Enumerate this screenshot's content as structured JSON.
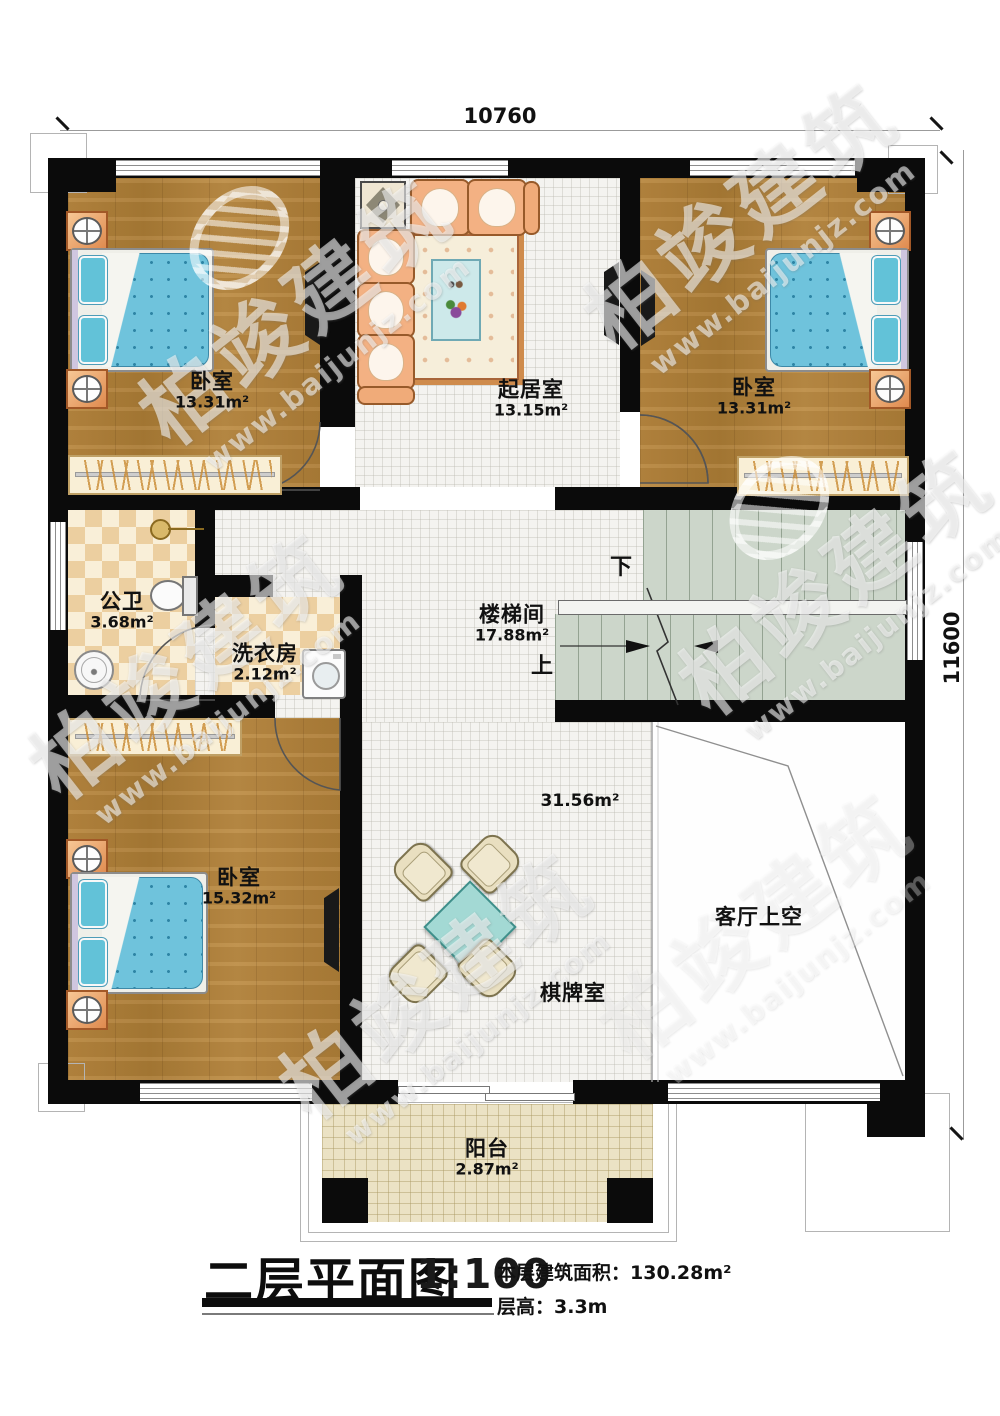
{
  "plan": {
    "dimensions": {
      "width_top": "10760",
      "height_right": "11600"
    },
    "rooms": [
      {
        "name": "卧室",
        "area": "13.31m²"
      },
      {
        "name": "起居室",
        "area": "13.15m²"
      },
      {
        "name": "卧室",
        "area": "13.31m²"
      },
      {
        "name": "公卫",
        "area": "3.68m²"
      },
      {
        "name": "洗衣房",
        "area": "2.12m²"
      },
      {
        "name": "楼梯间",
        "area": "17.88m²"
      },
      {
        "name": "卧室",
        "area": "15.32m²"
      },
      {
        "name": "棋牌室",
        "area": "31.56m²"
      },
      {
        "name": "客厅上空"
      },
      {
        "name": "阳台",
        "area": "2.87m²"
      }
    ],
    "stairs": {
      "down": "下",
      "up": "上"
    }
  },
  "title_block": {
    "title": "二层平面图",
    "scale": "1:100",
    "floor_area_label": "本层建筑面积：",
    "floor_area_value": "130.28m²",
    "floor_height_label": "层高：",
    "floor_height_value": "3.3m"
  },
  "watermark": {
    "brand": "柏竣建筑",
    "site": "www.baijunjz.com"
  }
}
